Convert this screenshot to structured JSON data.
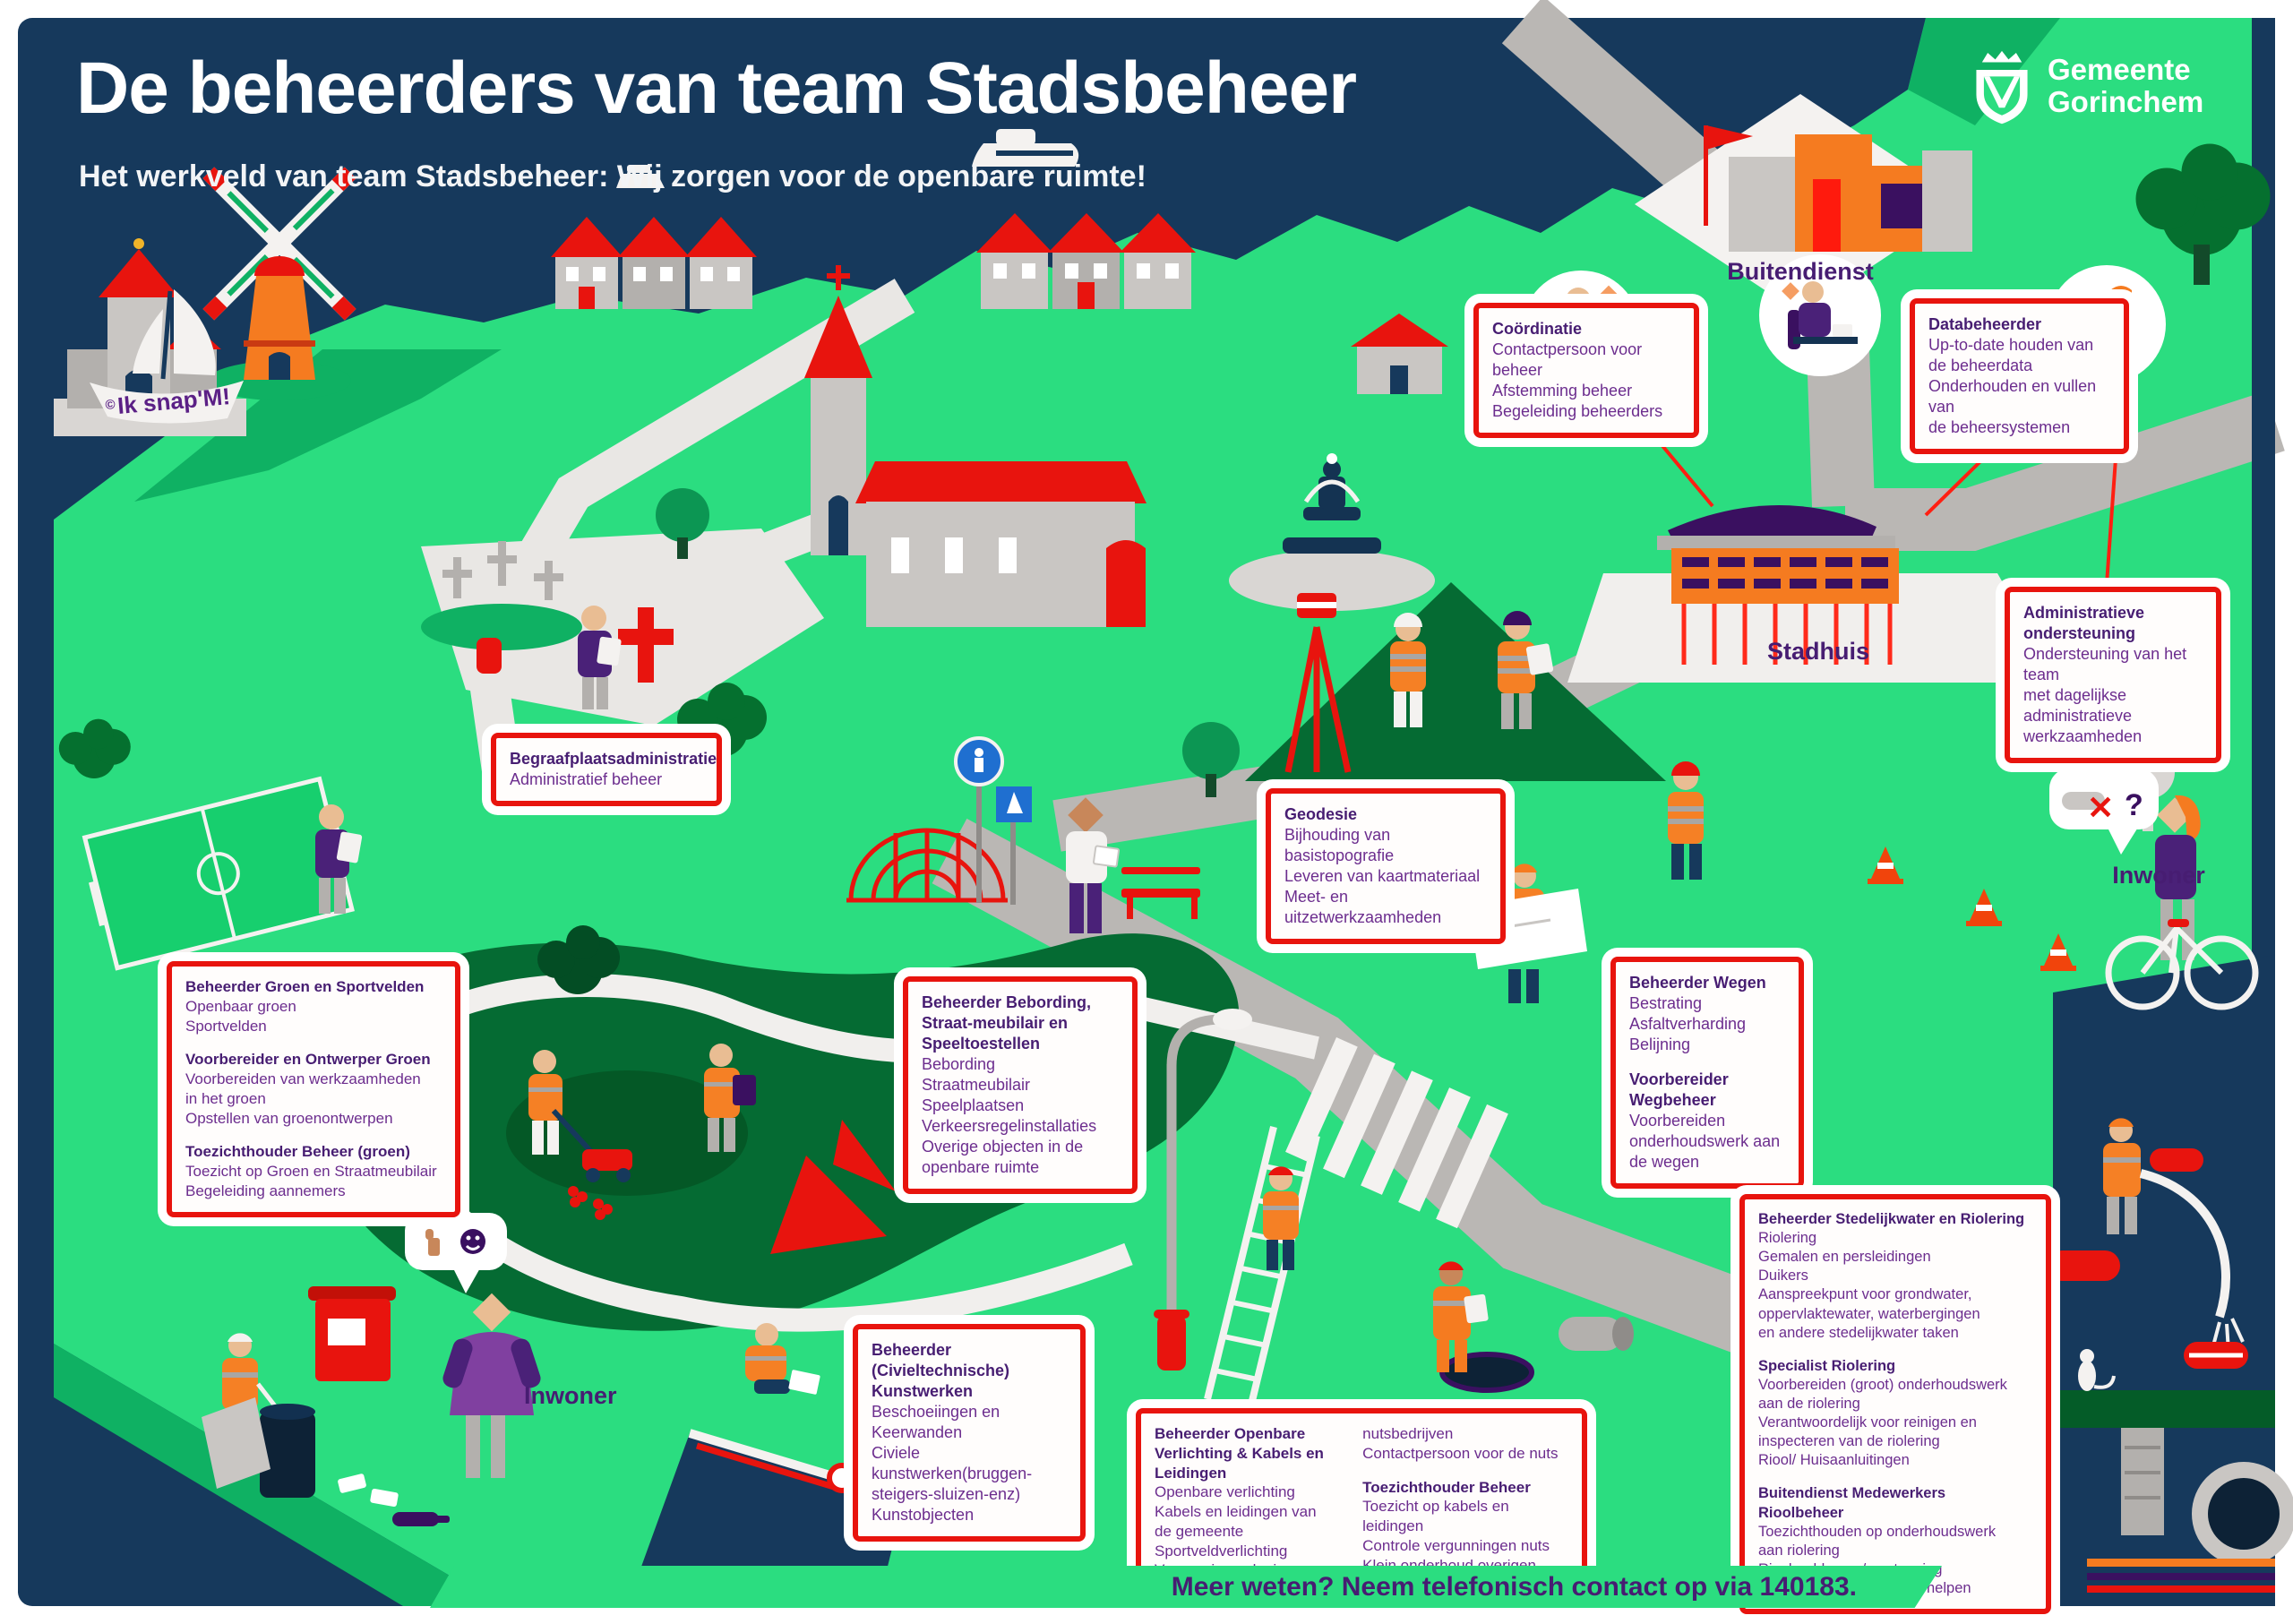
{
  "header": {
    "title": "De beheerders van team Stadsbeheer",
    "subtitle": "Het werkveld van team Stadsbeheer: Wij zorgen voor de openbare ruimte!"
  },
  "logo": {
    "line1": "Gemeente",
    "line2": "Gorinchem"
  },
  "boat_badge": {
    "mark": "©",
    "text": "Ik snap'M!"
  },
  "map_labels": {
    "buitendienst": "Buitendienst",
    "stadhuis": "Stadhuis",
    "inwoner_right": "Inwoner",
    "inwoner_left": "Inwoner"
  },
  "speech": {
    "cross": "✕",
    "question": "?"
  },
  "footer": {
    "text": "Meer weten? Neem telefonisch contact op via 140183."
  },
  "colors": {
    "navy": "#16395c",
    "green": "#2bdd80",
    "green_mid": "#0fb163",
    "green_dark": "#056b33",
    "red": "#e8140e",
    "orange": "#f57b20",
    "purple_title": "#471d72",
    "purple_body": "#6c2d8e",
    "purple_dark": "#3a1060",
    "road_gray": "#bab7b4"
  },
  "callouts": {
    "coordinatie": {
      "sections": [
        {
          "title": "Coördinatie",
          "body": "Contactpersoon voor beheer\nAfstemming beheer\nBegeleiding beheerders"
        }
      ]
    },
    "databeheerder": {
      "sections": [
        {
          "title": "Databeheerder",
          "body": "Up-to-date houden van\nde beheerdata\nOnderhouden en vullen van\nde beheersystemen"
        }
      ]
    },
    "admin": {
      "sections": [
        {
          "title": "Administratieve ondersteuning",
          "body": "Ondersteuning van het team\nmet dagelijkse administratieve\nwerkzaamheden"
        }
      ]
    },
    "begraafplaats": {
      "sections": [
        {
          "title": "Begraafplaatsadministratie",
          "body": "Administratief beheer"
        }
      ]
    },
    "geodesie": {
      "sections": [
        {
          "title": "Geodesie",
          "body": "Bijhouding van basistopografie\nLeveren van kaartmateriaal\nMeet- en uitzetwerkzaamheden"
        }
      ]
    },
    "groen": {
      "sections": [
        {
          "title": "Beheerder Groen en Sportvelden",
          "body": "Openbaar groen\nSportvelden"
        },
        {
          "title": "Voorbereider en Ontwerper Groen",
          "body": "Voorbereiden van werkzaamheden\nin het groen\nOpstellen van groenontwerpen"
        },
        {
          "title": "Toezichthouder Beheer (groen)",
          "body": "Toezicht op Groen en Straatmeubilair\nBegeleiding aannemers"
        }
      ]
    },
    "bebording": {
      "sections": [
        {
          "title": "Beheerder Bebording, Straat-meubilair en Speeltoestellen",
          "body": "Bebording\nStraatmeubilair\nSpeelplaatsen\nVerkeersregelinstallaties\nOverige objecten in de\nopenbare ruimte"
        }
      ]
    },
    "wegen": {
      "sections": [
        {
          "title": "Beheerder Wegen",
          "body": "Bestrating\nAsfaltverharding\nBelijning"
        },
        {
          "title": "Voorbereider Wegbeheer",
          "body": "Voorbereiden\nonderhoudswerk aan\nde wegen"
        }
      ]
    },
    "stedelijkwater": {
      "sections": [
        {
          "title": "Beheerder Stedelijkwater en Riolering",
          "body": "Riolering\nGemalen en persleidingen\nDuikers\nAanspreekpunt voor grondwater,\noppervlaktewater, waterbergingen\nen andere stedelijkwater taken"
        },
        {
          "title": "Specialist Riolering",
          "body": "Voorbereiden (groot) onderhoudswerk\naan de riolering\nVerantwoordelijk voor reinigen en\ninspecteren van de riolering\nRiool/ Huisaanluitingen"
        },
        {
          "title": "Buitendienst Medewerkers Rioolbeheer",
          "body": "Toezichthouden op onderhoudswerk\naan riolering\nRioolproblemen/verstopping\ncontroleren-adviseren-verhelpen"
        }
      ]
    },
    "verlichting": {
      "col1": {
        "sections": [
          {
            "title": "Beheerder Openbare Verlichting & Kabels en Leidingen",
            "body": "Openbare verlichting\nKabels en leidingen van\nde gemeente\nSportveldverlichting\nVergunningverlening van"
          }
        ]
      },
      "col2": {
        "sections": [
          {
            "title": "",
            "body": "nutsbedrijven\nContactpersoon voor de nuts"
          },
          {
            "title": "Toezichthouder Beheer",
            "body": "Toezicht op kabels en leidingen\nControle vergunningen nuts\nKlein onderhoud overigen"
          }
        ]
      }
    },
    "kunstwerken": {
      "sections": [
        {
          "title": "Beheerder (Civieltechnische) Kunstwerken",
          "body": "Beschoeiingen en Keerwanden\nCiviele kunstwerken(bruggen-\nsteigers-sluizen-enz)\nKunstobjecten"
        }
      ]
    }
  }
}
